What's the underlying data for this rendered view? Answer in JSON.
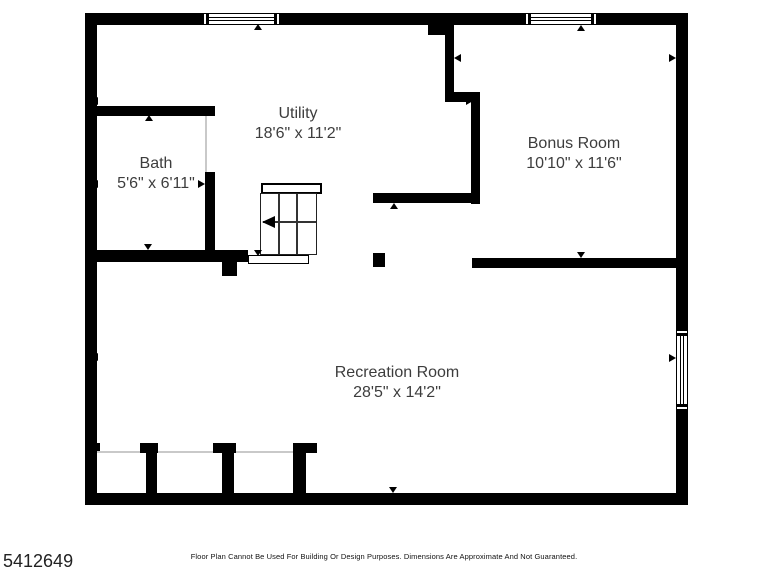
{
  "floor_plan": {
    "rooms": [
      {
        "name": "Utility",
        "dims": "18'6\" x 11'2\""
      },
      {
        "name": "Bath",
        "dims": "5'6\" x 6'11\""
      },
      {
        "name": "Bonus Room",
        "dims": "10'10\" x 11'6\""
      },
      {
        "name": "Recreation Room",
        "dims": "28'5\" x 14'2\""
      }
    ],
    "features": [
      "stairs",
      "window-top-utility",
      "window-top-bonus",
      "window-right-recreation",
      "closets-bottom",
      "support-post"
    ],
    "colors": {
      "wall": "#000000",
      "label_text": "#3d3d3d",
      "faint_opening_line": "#c9c9c9",
      "background": "#ffffff"
    }
  },
  "footer": {
    "listing_id": "5412649",
    "disclaimer": "Floor Plan Cannot Be Used For Building Or Design Purposes. Dimensions Are Approximate And Not Guaranteed."
  }
}
